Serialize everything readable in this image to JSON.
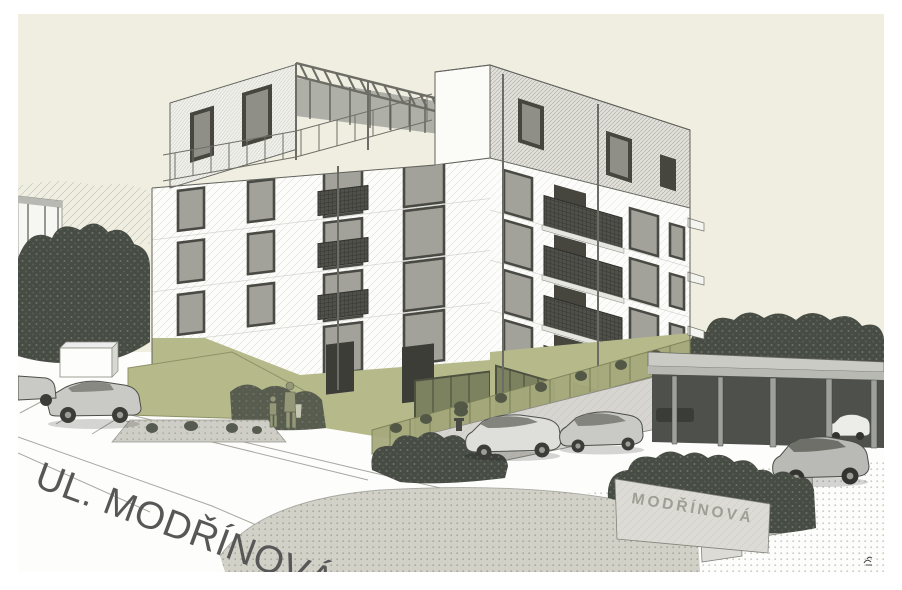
{
  "artwork": {
    "street_label": "UL. MODŘÍNOVÁ",
    "sign_label": "MODŘÍNOVÁ"
  },
  "colors": {
    "paper": "#ffffff",
    "sky": "#efeee1",
    "facade": "#fcfcfa",
    "accent_olive": "#b6ba8a",
    "olive_glass": "#7c8160",
    "ink": "#55554f",
    "tree": "#474c44",
    "lawn": "#d2d1c7",
    "car": "#c9c9c5",
    "stone": "#dcdbd5",
    "sign_text": "#96958c",
    "street_text": "#575757",
    "carport": "#4e504c"
  }
}
